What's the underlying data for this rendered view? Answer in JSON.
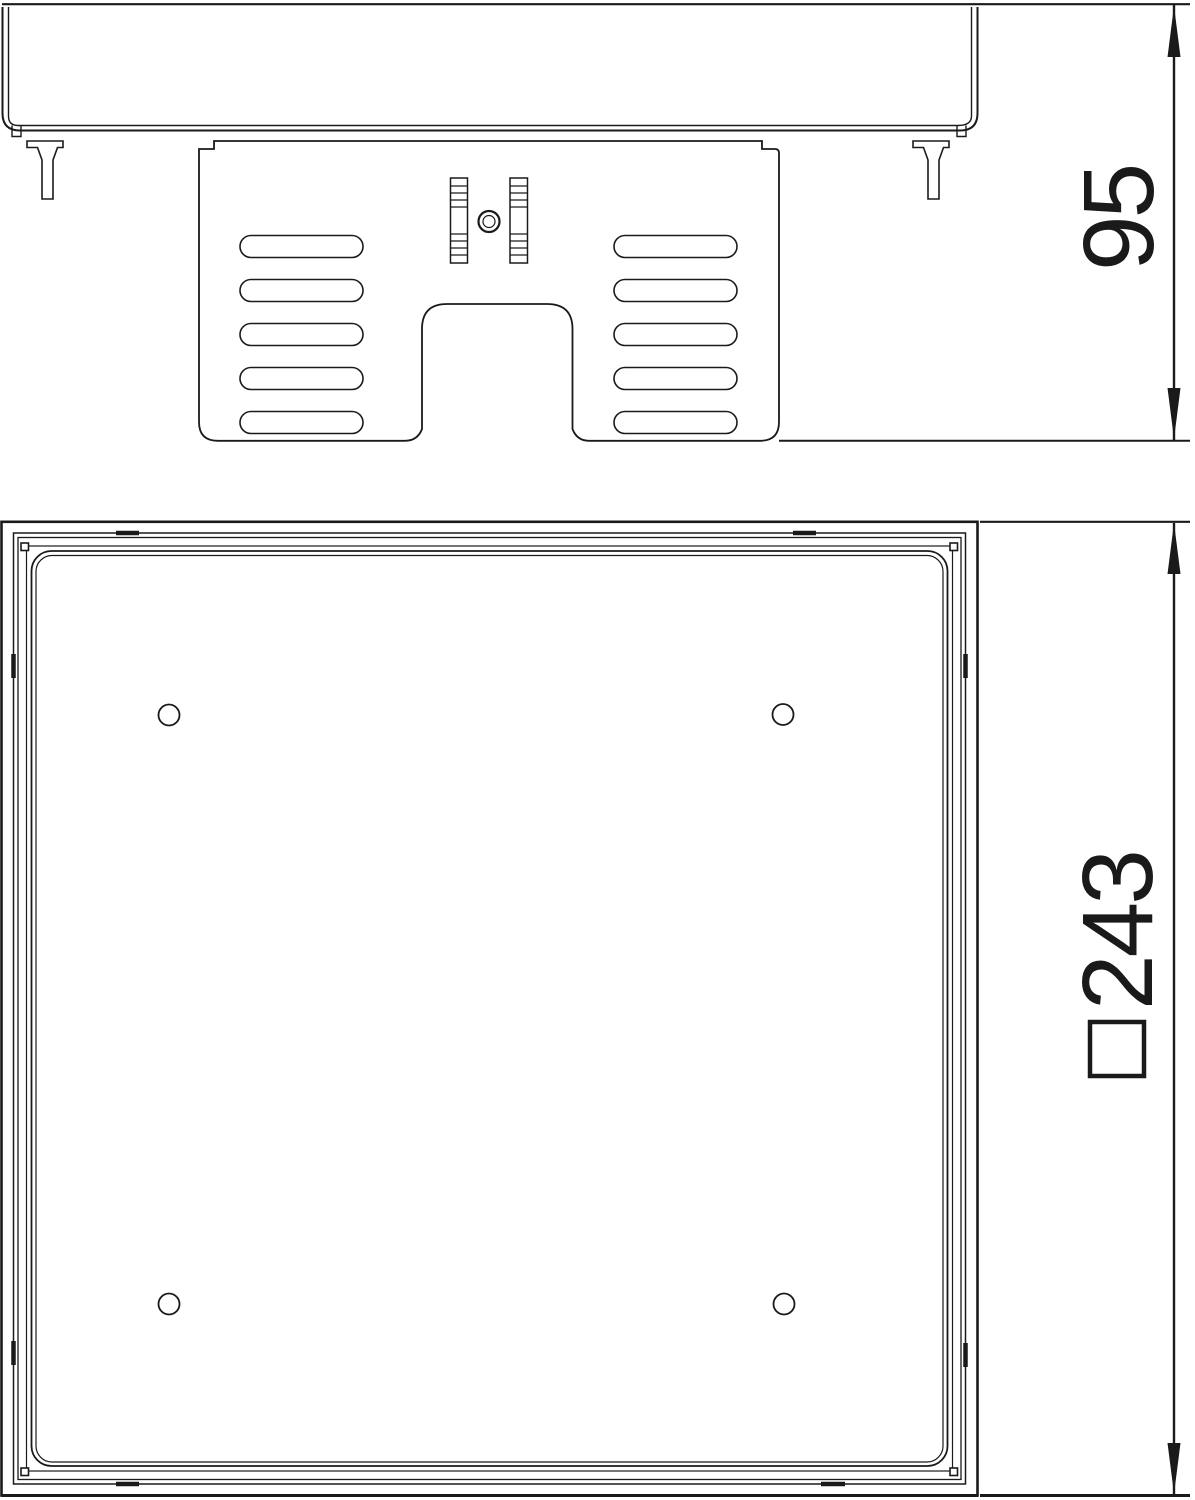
{
  "drawing": {
    "background_color": "#ffffff",
    "line_color": "#1a1a1a",
    "side_view": {
      "description_name": "side-elevation-view",
      "dimension": {
        "label": "95"
      }
    },
    "plan_view": {
      "description_name": "underside-plan-view",
      "dimension": {
        "label": "243",
        "symbol_icon": "square-outline"
      }
    }
  }
}
